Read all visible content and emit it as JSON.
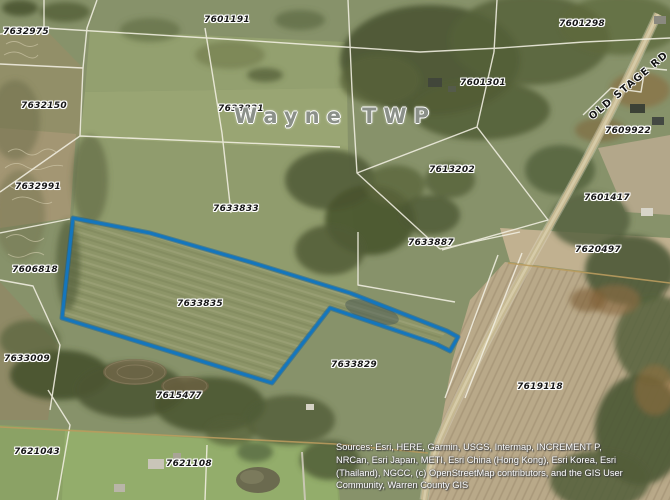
{
  "map": {
    "township_label": "Wayne TWP",
    "road_label": "OLD STAGE RD",
    "selected_parcel": "7633835",
    "colors": {
      "selection_outline": "#1476bd",
      "selection_outline_dark": "#0d5e9c",
      "parcel_line": "#f2efe2",
      "survey_line_tan": "#b99b5e",
      "label_text": "#161616",
      "label_halo": "#ffffff",
      "township_text": "#8b9089"
    },
    "parcels": [
      {
        "id": "7632975",
        "x": 26,
        "y": 32
      },
      {
        "id": "7601191",
        "x": 227,
        "y": 20
      },
      {
        "id": "7601298",
        "x": 582,
        "y": 24
      },
      {
        "id": "7632150",
        "x": 44,
        "y": 106
      },
      {
        "id": "7633831",
        "x": 241,
        "y": 109
      },
      {
        "id": "7601301",
        "x": 483,
        "y": 83
      },
      {
        "id": "7609922",
        "x": 628,
        "y": 131
      },
      {
        "id": "7613202",
        "x": 452,
        "y": 170
      },
      {
        "id": "7601417",
        "x": 607,
        "y": 198
      },
      {
        "id": "7632991",
        "x": 38,
        "y": 187
      },
      {
        "id": "7633833",
        "x": 236,
        "y": 209
      },
      {
        "id": "7633887",
        "x": 431,
        "y": 243
      },
      {
        "id": "7620497",
        "x": 598,
        "y": 250
      },
      {
        "id": "7606818",
        "x": 35,
        "y": 270
      },
      {
        "id": "7633835",
        "x": 200,
        "y": 304
      },
      {
        "id": "7633009",
        "x": 27,
        "y": 359
      },
      {
        "id": "7633829",
        "x": 354,
        "y": 365
      },
      {
        "id": "7615477",
        "x": 179,
        "y": 396
      },
      {
        "id": "7619118",
        "x": 540,
        "y": 387
      },
      {
        "id": "7621043",
        "x": 37,
        "y": 452
      },
      {
        "id": "7621108",
        "x": 189,
        "y": 464
      }
    ],
    "township_pos": {
      "x": 335,
      "y": 116
    },
    "road_label_pos": {
      "x": 629,
      "y": 86
    }
  },
  "attribution": {
    "lines": [
      "Sources: Esri, HERE, Garmin, USGS, Intermap, INCREMENT P,",
      "NRCan, Esri Japan, METI, Esri China (Hong Kong), Esri Korea, Esri",
      "(Thailand), NGCC, (c) OpenStreetMap contributors, and the GIS User",
      "Community, Warren County GIS"
    ]
  }
}
